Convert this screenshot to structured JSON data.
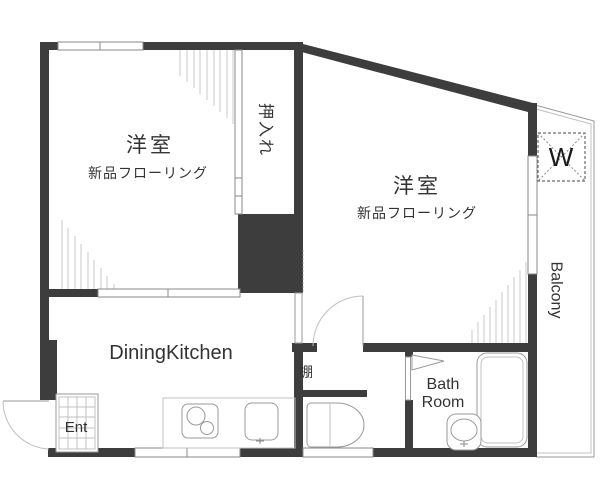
{
  "floorplan": {
    "rooms": {
      "western_room_left": {
        "label": "洋室",
        "sublabel": "新品フローリング"
      },
      "western_room_right": {
        "label": "洋室",
        "sublabel": "新品フローリング"
      },
      "closet": {
        "label": "押入れ"
      },
      "dining_kitchen": {
        "label": "DiningKitchen"
      },
      "entrance": {
        "label": "Ent"
      },
      "shelf": {
        "label": "棚"
      },
      "bathroom": {
        "line1": "Bath",
        "line2": "Room"
      },
      "balcony": {
        "label": "Balcony"
      },
      "washer_spot": {
        "label": "W"
      }
    },
    "colors": {
      "wall": "#3d3d3d",
      "line": "#9a9a9a",
      "hatch": "#c9c9c9",
      "text": "#333333",
      "background": "#ffffff"
    }
  }
}
